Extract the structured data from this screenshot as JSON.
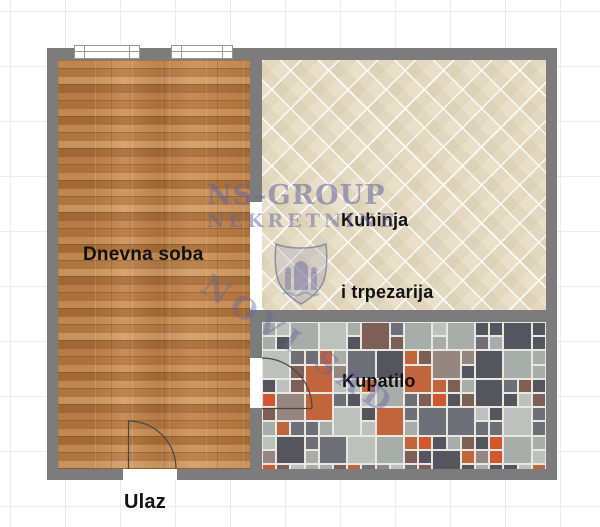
{
  "plan": {
    "rooms": [
      {
        "id": "living-room",
        "label": "Dnevna soba"
      },
      {
        "id": "kitchen-dining",
        "label_line1": "Kuhinja",
        "label_line2": "i trpezarija"
      },
      {
        "id": "bathroom",
        "label": "Kupatilo"
      }
    ],
    "entrance_label": "Ulaz"
  },
  "watermark": {
    "brand": "NS–GROUP",
    "subtitle": "NEKRETNINE",
    "city": "NOVI SAD",
    "emblem": "novi-sad-coat-of-arms"
  },
  "colors": {
    "wall": "#7c7c7c",
    "grid_line": "#ebecf2",
    "wood_base": "#c08a50",
    "tile_base": "#e8e0c8",
    "label_text": "#111111",
    "mosaic_grout": "#e9e7e2",
    "mosaic_palette": [
      "#55555d",
      "#6f6f77",
      "#a7ada8",
      "#bcc1bd",
      "#c2643c",
      "#d2572e",
      "#7d5f55",
      "#958780"
    ]
  },
  "mosaic": {
    "seed": 42,
    "weights": [
      0.2,
      0.15,
      0.2,
      0.12,
      0.11,
      0.06,
      0.09,
      0.07
    ],
    "pitch": 14.2,
    "grout": 2,
    "big_tile_chance": 0.3
  }
}
